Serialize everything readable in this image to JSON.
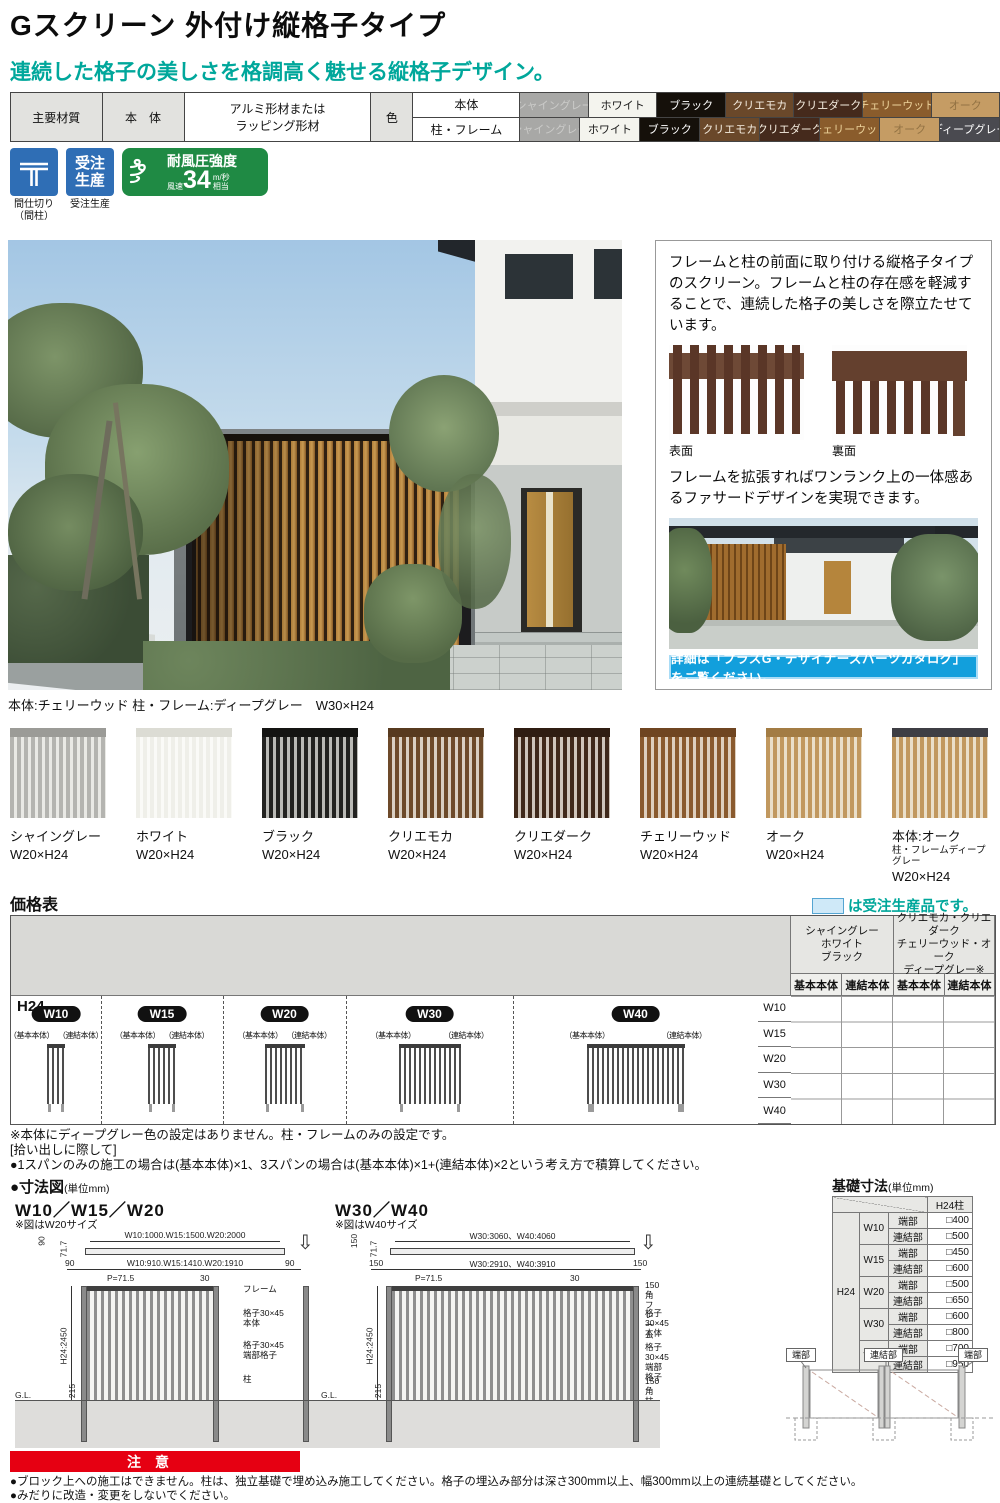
{
  "page": {
    "title": "Gスクリーン 外付け縦格子タイプ",
    "subtitle": "連続した格子の美しさを格調高く魅せる縦格子デザイン。"
  },
  "theme": {
    "teal": "#00a79b",
    "red": "#e60012",
    "badge_blue": "#2f6eb5",
    "badge_green": "#1f8a44",
    "banner_blue": "#129fdc",
    "legend_fill": "#cfe9f8"
  },
  "spec": {
    "material_label": "主要材質",
    "body_label": "本　体",
    "material_value": "アルミ形材または\nラッピング形材",
    "color_label": "色",
    "rows": [
      {
        "target": "本体",
        "colors": [
          {
            "name": "シャイングレー",
            "bg": "#a8a8a6",
            "fg": "#cbcbc9"
          },
          {
            "name": "ホワイト",
            "bg": "#f4f4ee",
            "fg": "#1a1a1a"
          },
          {
            "name": "ブラック",
            "bg": "#15100a",
            "fg": "#ffffff"
          },
          {
            "name": "クリエモカ",
            "bg": "#6a482a",
            "fg": "#f5ede0"
          },
          {
            "name": "クリエダーク",
            "bg": "#452a1c",
            "fg": "#f5ede0"
          },
          {
            "name": "チェリーウッド",
            "bg": "#8a5c2c",
            "fg": "#ecd29a"
          },
          {
            "name": "オーク",
            "bg": "#c59c64",
            "fg": "#927243"
          }
        ]
      },
      {
        "target": "柱・フレーム",
        "colors": [
          {
            "name": "シャイングレー",
            "bg": "#a8a8a6",
            "fg": "#cbcbc9"
          },
          {
            "name": "ホワイト",
            "bg": "#f4f4ee",
            "fg": "#1a1a1a"
          },
          {
            "name": "ブラック",
            "bg": "#15100a",
            "fg": "#ffffff"
          },
          {
            "name": "クリエモカ",
            "bg": "#6a482a",
            "fg": "#f5ede0"
          },
          {
            "name": "クリエダーク",
            "bg": "#452a1c",
            "fg": "#f5ede0"
          },
          {
            "name": "チェリーウッド",
            "bg": "#8a5c2c",
            "fg": "#ecd29a"
          },
          {
            "name": "オーク",
            "bg": "#c59c64",
            "fg": "#927243"
          },
          {
            "name": "ディープグレー",
            "bg": "#4a4a50",
            "fg": "#ffffff"
          }
        ]
      }
    ]
  },
  "badges": {
    "partition": {
      "caption": "間仕切り\n（間柱）"
    },
    "order": {
      "label": "受注\n生産",
      "caption": "受注生産"
    },
    "wind": {
      "title": "耐風圧強度",
      "speed_label": "風速",
      "value": "34",
      "unit": "m/秒",
      "suffix": "相当"
    }
  },
  "hero": {
    "caption": "本体:チェリーウッド 柱・フレーム:ディープグレー　W30×H24"
  },
  "info_panel": {
    "para1": "フレームと柱の前面に取り付ける縦格子タイプのスクリーン。フレームと柱の存在感を軽減することで、連続した格子の美しさを際立たせています。",
    "face_front_label": "表面",
    "face_back_label": "裏面",
    "para2": "フレームを拡張すればワンランク上の一体感あるファサードデザインを実現できます。",
    "banner": "詳細は「プラスG・デザイナーズパーツカタログ」をご覧ください。"
  },
  "swatches": [
    {
      "name": "シャイングレー",
      "sub": "",
      "size": "W20×H24",
      "slat": "#b4b4b0",
      "gap": "#e9e9e5",
      "frame": "#9b9b97"
    },
    {
      "name": "ホワイト",
      "sub": "",
      "size": "W20×H24",
      "slat": "#efefe9",
      "gap": "#fafaf7",
      "frame": "#dcdcd4"
    },
    {
      "name": "ブラック",
      "sub": "",
      "size": "W20×H24",
      "slat": "#222220",
      "gap": "#b9b9b5",
      "frame": "#141412"
    },
    {
      "name": "クリエモカ",
      "sub": "",
      "size": "W20×H24",
      "slat": "#6d4a2a",
      "gap": "#d9cfc2",
      "frame": "#573a1f"
    },
    {
      "name": "クリエダーク",
      "sub": "",
      "size": "W20×H24",
      "slat": "#40291b",
      "gap": "#cfc5bb",
      "frame": "#2f1d12"
    },
    {
      "name": "チェリーウッド",
      "sub": "",
      "size": "W20×H24",
      "slat": "#8a5a2e",
      "gap": "#decfbe",
      "frame": "#6f4521"
    },
    {
      "name": "オーク",
      "sub": "",
      "size": "W20×H24",
      "slat": "#c1985f",
      "gap": "#eadfca",
      "frame": "#a37c44"
    },
    {
      "name": "本体:オーク",
      "sub": "柱・フレームディープグレー",
      "size": "W20×H24",
      "slat": "#c1985f",
      "gap": "#eadfca",
      "frame": "#3e3e44"
    }
  ],
  "price": {
    "heading": "価格表",
    "legend_text": "は受注生産品です。",
    "col_group1": "シャイングレー\nホワイト\nブラック",
    "col_group2": "クリエモカ・クリエダーク\nチェリーウッド・オーク\nディープグレー※",
    "sub_cols": [
      "基本本体",
      "連結本体",
      "基本本体",
      "連結本体"
    ],
    "row_label": "H24",
    "sizes": [
      {
        "name": "W10",
        "base_label": "（基本本体）",
        "link_label": "（連結本体）"
      },
      {
        "name": "W15",
        "base_label": "（基本本体）",
        "link_label": "（連結本体）"
      },
      {
        "name": "W20",
        "base_label": "（基本本体）",
        "link_label": "（連結本体）"
      },
      {
        "name": "W30",
        "base_label": "（基本本体）",
        "link_label": "（連結本体）"
      },
      {
        "name": "W40",
        "base_label": "（基本本体）",
        "link_label": "（連結本体）"
      }
    ],
    "side_labels": [
      "W10",
      "W15",
      "W20",
      "W30",
      "W40"
    ]
  },
  "notes": [
    "※本体にディープグレー色の設定はありません。柱・フレームのみの設定です。",
    "[拾い出しに際して]",
    "●1スパンのみの施工の場合は(基本本体)×1、3スパンの場合は(基本本体)×1+(連結本体)×2という考え方で積算してください。"
  ],
  "dim_section": {
    "heading": "●寸法図",
    "unit": "(単位mm)",
    "d1": {
      "title": "W10／W15／W20",
      "note": "※図はW20サイズ",
      "top_dim": "W10:1000.W15:1500.W20:2000",
      "v1": "90",
      "v2": "71.7",
      "left_end": "90",
      "inner_dim": "W10:910.W15:1410.W20:1910",
      "right_end": "90",
      "pitch": "P=71.5",
      "slat": "30",
      "lbl_frame": "フレーム",
      "lbl_body": "格子30×45\n本体",
      "lbl_end": "格子30×45\n端部格子",
      "lbl_post": "柱",
      "height": "H24:2450",
      "embed": "215",
      "depth": "500",
      "gl": "G.L."
    },
    "d2": {
      "title": "W30／W40",
      "note": "※図はW40サイズ",
      "top_dim": "W30:3060、W40:4060",
      "v1": "150",
      "v2": "71.7",
      "left_end": "150",
      "inner_dim": "W30:2910、W40:3910",
      "right_end": "150",
      "pitch": "P=71.5",
      "slat": "30",
      "lbl_frame": "150角フレーム",
      "lbl_body": "格子30×45\n本体",
      "lbl_end": "格子30×45\n端部格子",
      "lbl_post": "150角柱",
      "height": "H24:2450",
      "embed": "215",
      "depth": "500",
      "gl": "G.L."
    }
  },
  "foundation": {
    "heading": "基礎寸法",
    "unit": "(単位mm)",
    "col_header": "H24柱",
    "row_group": "H24",
    "rows": [
      {
        "size": "W10",
        "p1": "端部",
        "v1": "□400",
        "p2": "連結部",
        "v2": "□500"
      },
      {
        "size": "W15",
        "p1": "端部",
        "v1": "□450",
        "p2": "連結部",
        "v2": "□600"
      },
      {
        "size": "W20",
        "p1": "端部",
        "v1": "□500",
        "p2": "連結部",
        "v2": "□650"
      },
      {
        "size": "W30",
        "p1": "端部",
        "v1": "□600",
        "p2": "連結部",
        "v2": "□800"
      },
      {
        "size": "W40",
        "p1": "端部",
        "v1": "□700",
        "p2": "連結部",
        "v2": "□950"
      }
    ],
    "schematic_labels": [
      "端部",
      "連結部",
      "端部"
    ]
  },
  "caution": {
    "badge": "注意",
    "lines": [
      "●ブロック上への施工はできません。柱は、独立基礎で埋め込み施工してください。格子の埋込み部分は深さ300mm以上、幅300mm以上の連続基礎としてください。",
      "●みだりに改造・変更をしないでください。"
    ]
  }
}
